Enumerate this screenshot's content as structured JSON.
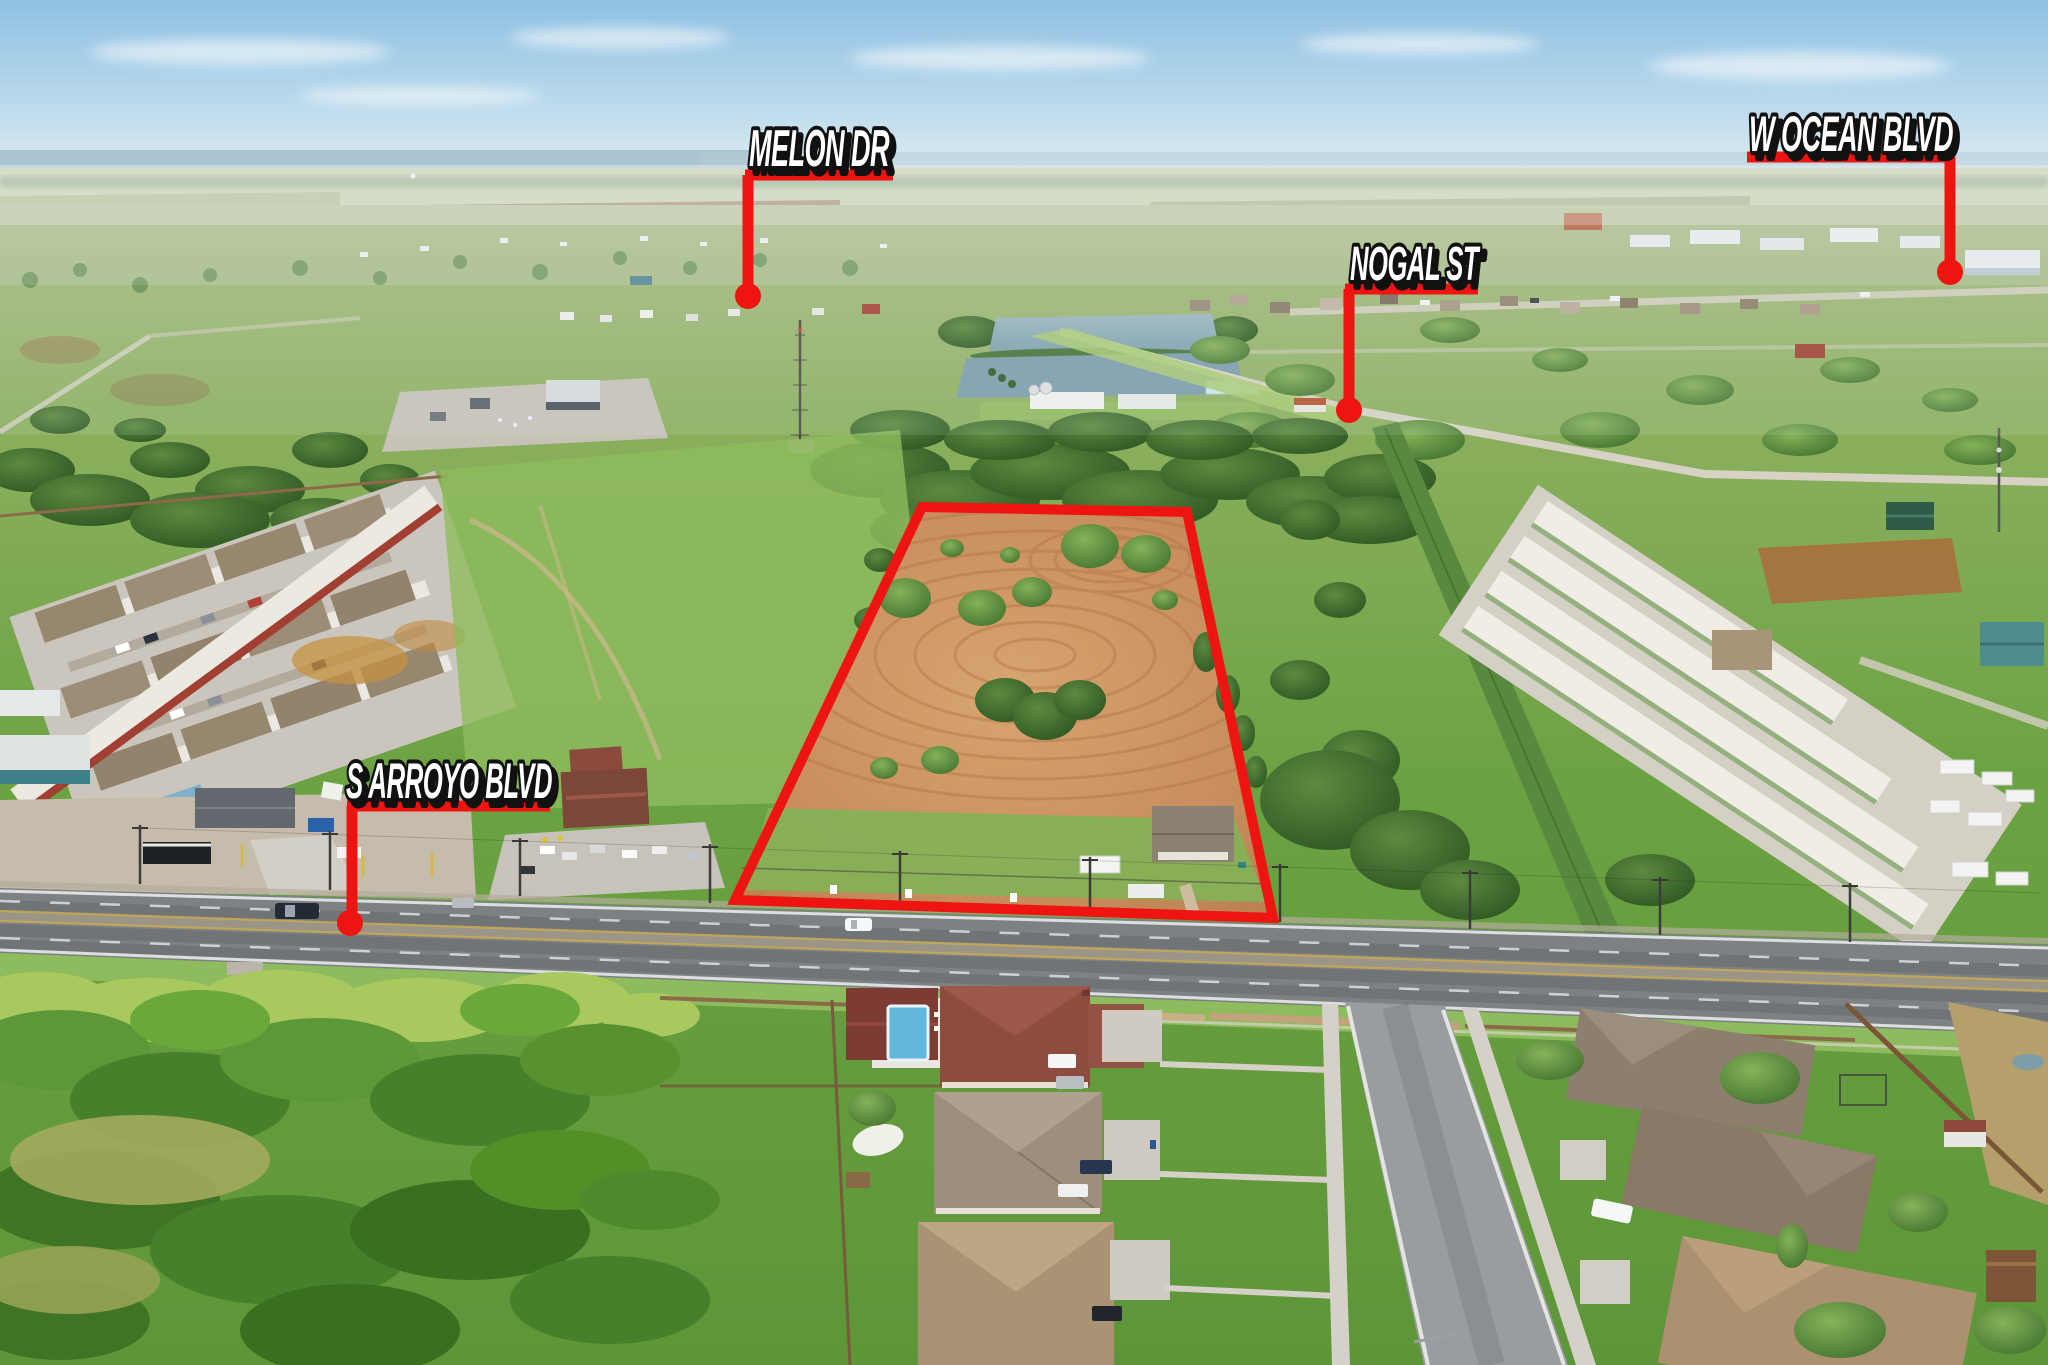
{
  "annotation_color": "#ee1411",
  "label_fill_color": "#ffffff",
  "label_outline_color": "#111111",
  "street_labels": [
    {
      "id": "melon-dr",
      "text": "MELON DR",
      "text_x": 819,
      "text_y": 166,
      "font_size": 52,
      "text_length": 140,
      "underline": [
        745,
        175,
        893,
        175
      ],
      "leader": [
        748,
        175,
        748,
        296
      ],
      "dot": [
        748,
        296,
        13
      ]
    },
    {
      "id": "w-ocean-blvd",
      "text": "W OCEAN BLVD",
      "text_x": 1851,
      "text_y": 151,
      "font_size": 50,
      "text_length": 204,
      "underline": [
        1747,
        157,
        1950,
        157
      ],
      "leader": [
        1950,
        157,
        1950,
        272
      ],
      "dot": [
        1950,
        272,
        13
      ]
    },
    {
      "id": "nogal-st",
      "text": "NOGAL ST",
      "text_x": 1414,
      "text_y": 280,
      "font_size": 48,
      "text_length": 128,
      "underline": [
        1345,
        289,
        1478,
        289
      ],
      "leader": [
        1349,
        289,
        1349,
        408
      ],
      "dot": [
        1349,
        410,
        13
      ]
    },
    {
      "id": "s-arroyo-blvd",
      "text": "S ARROYO BLVD",
      "text_x": 449,
      "text_y": 798,
      "font_size": 50,
      "text_length": 206,
      "underline": [
        347,
        806,
        550,
        806
      ],
      "leader": [
        352,
        806,
        352,
        920
      ],
      "dot": [
        350,
        923,
        13
      ]
    }
  ],
  "property_boundary": {
    "points": [
      [
        922,
        507
      ],
      [
        1187,
        512
      ],
      [
        1273,
        918
      ],
      [
        735,
        900
      ]
    ],
    "stroke_width": 10
  }
}
